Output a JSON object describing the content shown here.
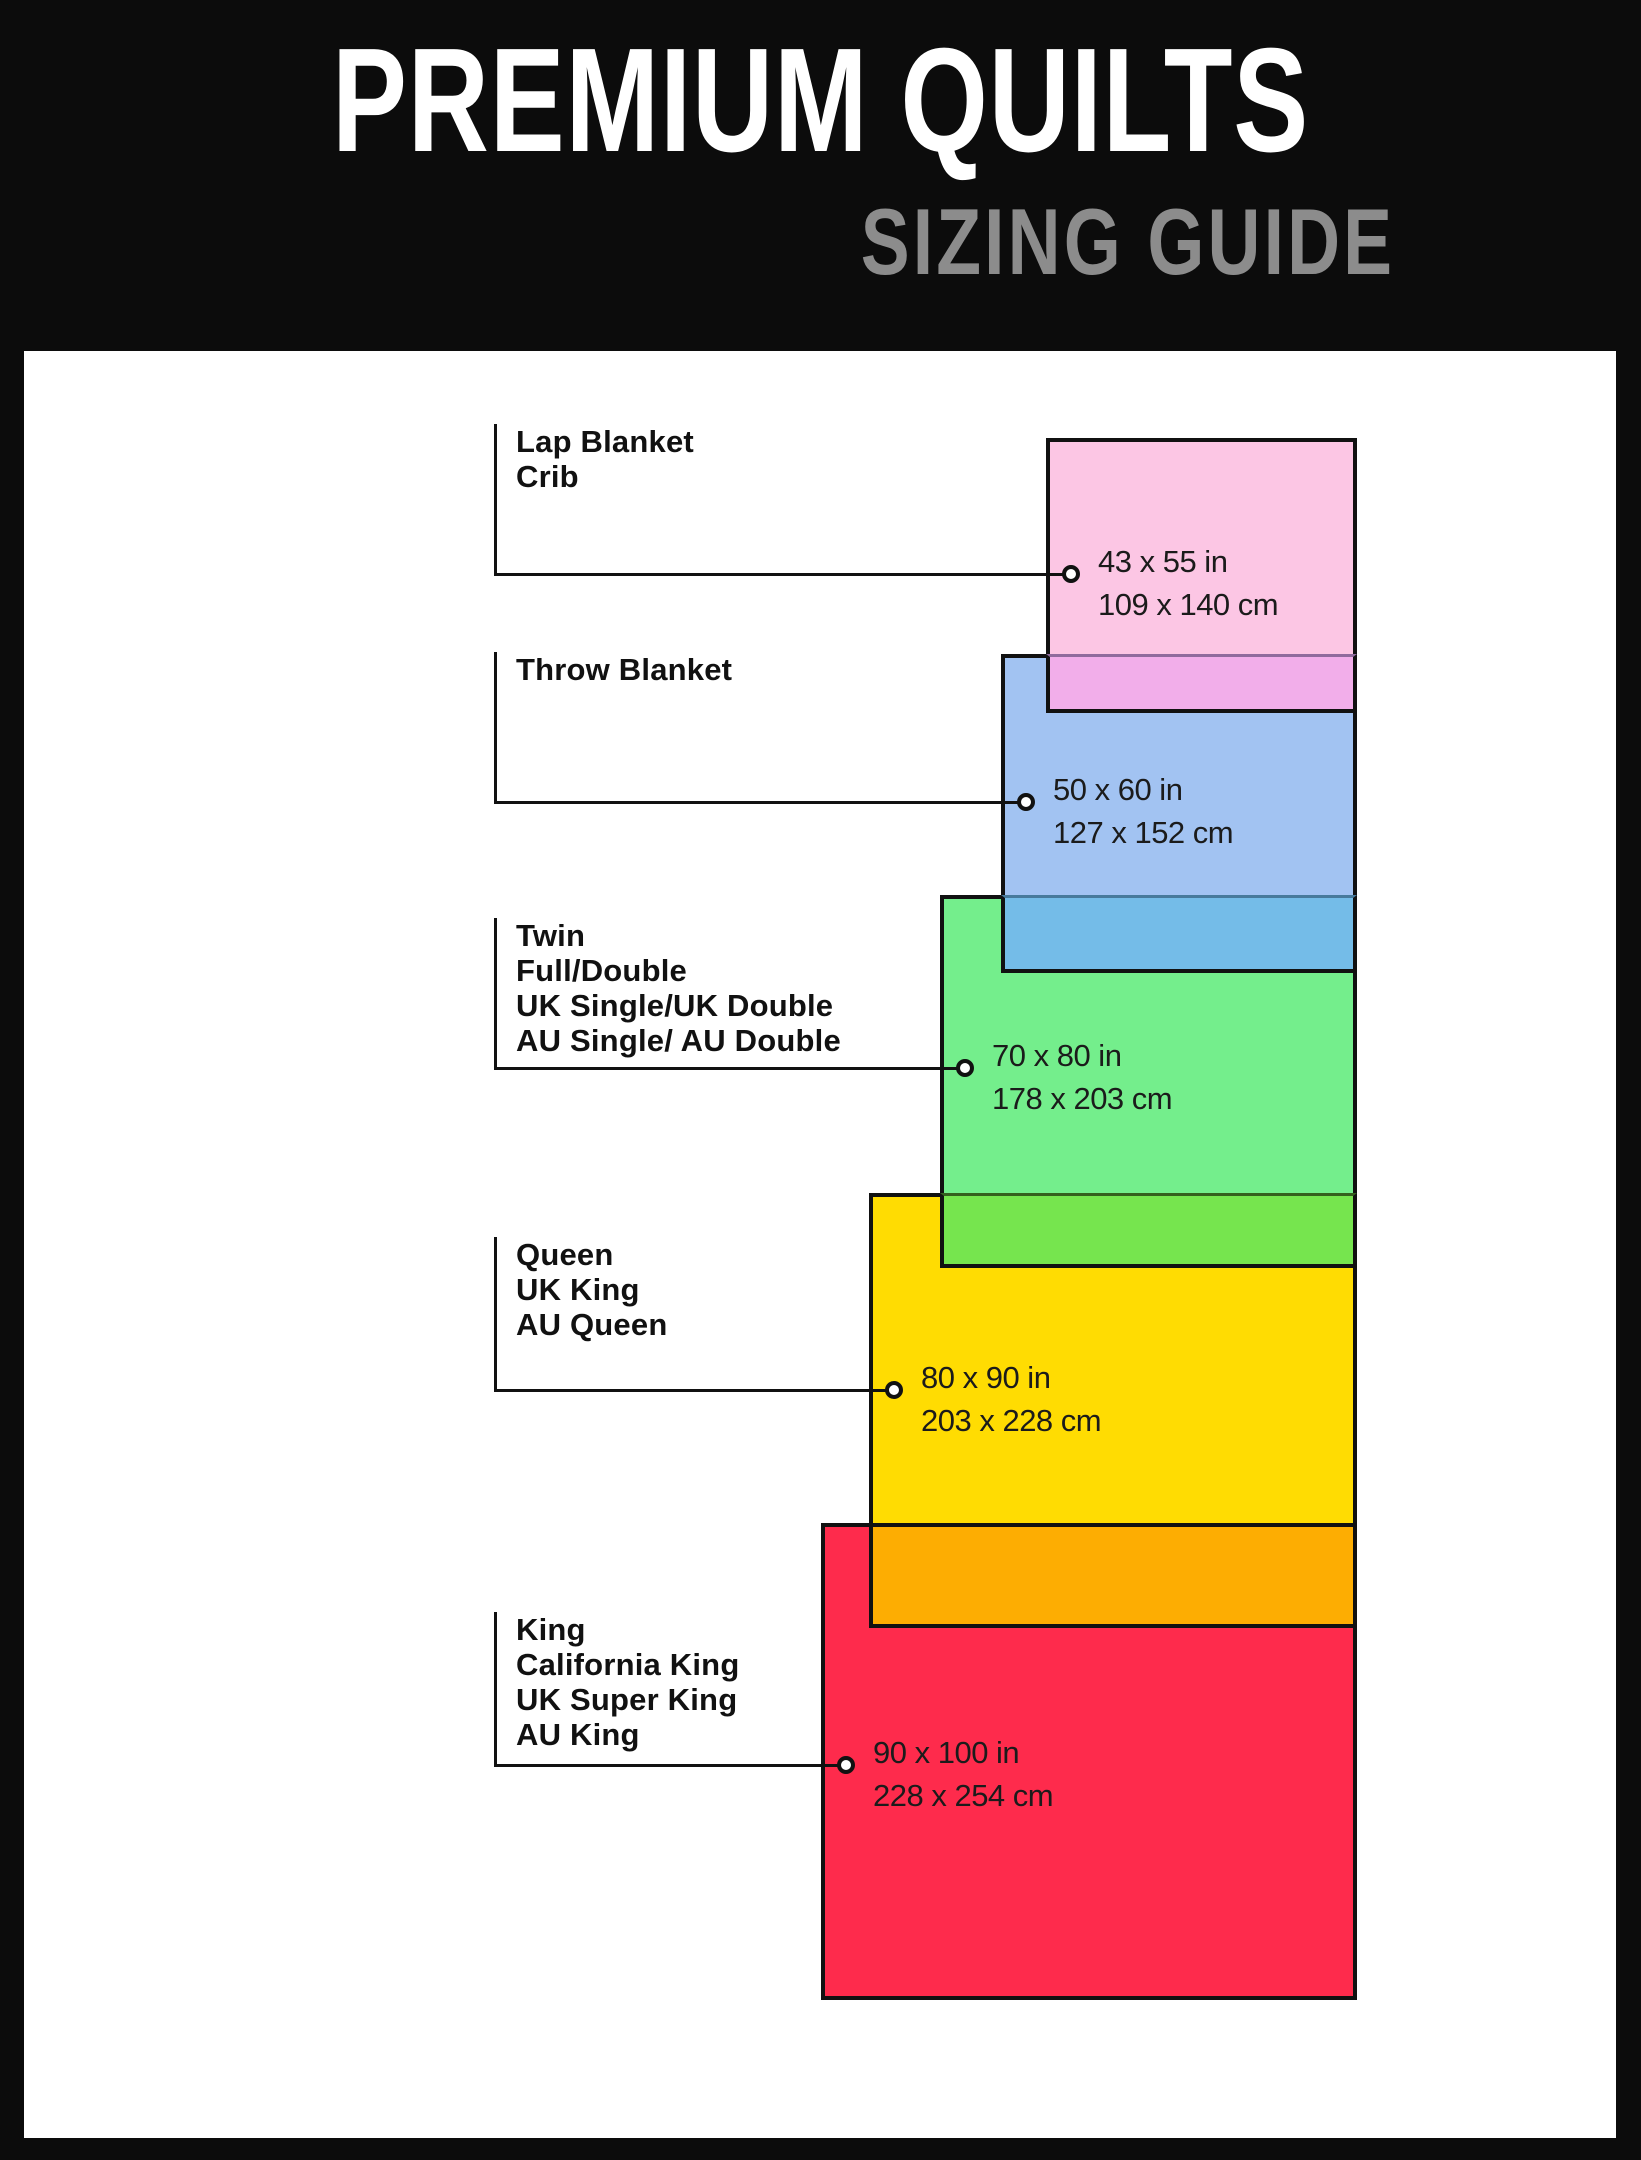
{
  "header": {
    "title": "PREMIUM QUILTS",
    "subtitle": "SIZING GUIDE"
  },
  "sizes": [
    {
      "labels": [
        "Lap Blanket",
        "Crib"
      ],
      "inches": "43 x 55 in",
      "centimeters": "109 x 140 cm",
      "color": "#fcc6e4"
    },
    {
      "labels": [
        "Throw Blanket"
      ],
      "inches": "50 x 60 in",
      "centimeters": "127 x 152 cm",
      "color": "#a2c3f2"
    },
    {
      "labels": [
        "Twin",
        "Full/Double",
        "UK Single/UK Double",
        "AU Single/ AU Double"
      ],
      "inches": "70 x 80 in",
      "centimeters": "178 x 203 cm",
      "color": "#74ee8c"
    },
    {
      "labels": [
        "Queen",
        "UK King",
        "AU Queen"
      ],
      "inches": "80 x 90 in",
      "centimeters": "203 x 228 cm",
      "color": "#ffdc02"
    },
    {
      "labels": [
        "King",
        "California King",
        "UK Super King",
        "AU King"
      ],
      "inches": "90 x 100 in",
      "centimeters": "228 x 254 cm",
      "color": "#fe2b4c"
    }
  ],
  "overlap_colors": {
    "pink_over_blue": "#f2aeea",
    "blue_over_green": "#74bce8",
    "green_over_yellow": "#76e54e",
    "yellow_over_red": "#fdad02"
  },
  "frame_color": "#0c0c0c",
  "subtitle_color": "#8c8c8c"
}
